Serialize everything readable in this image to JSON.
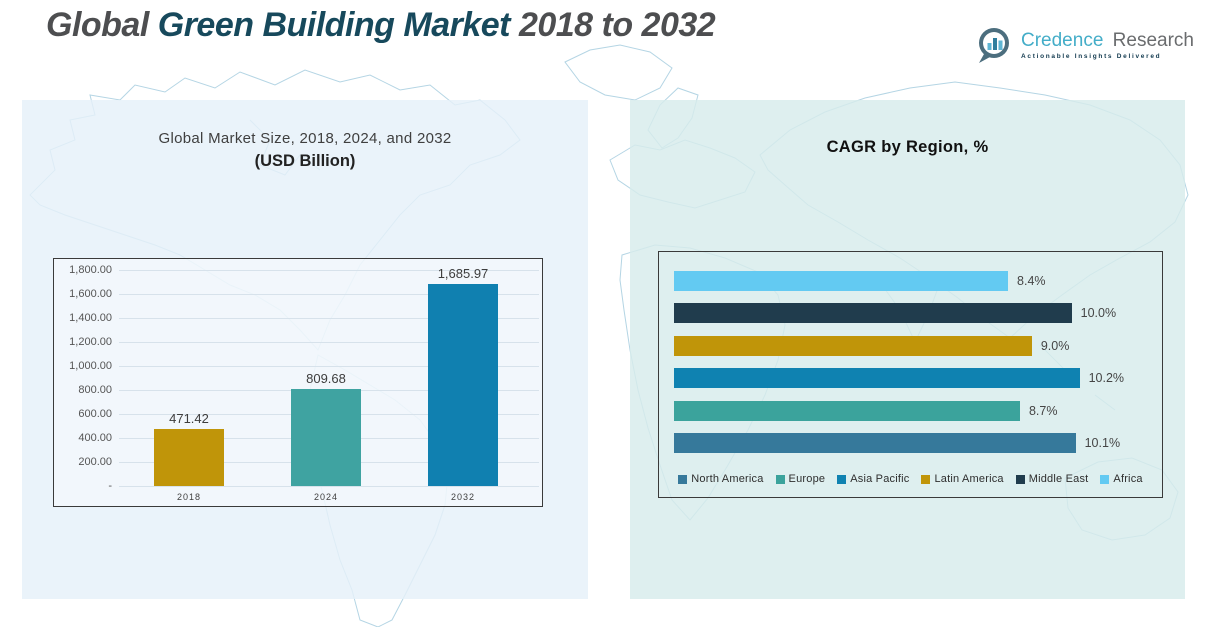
{
  "header": {
    "title": {
      "part1": "Global",
      "part2": "Green Building Market",
      "part3": "2018 to 2032"
    },
    "logo": {
      "brand_primary": "Credence",
      "brand_secondary": "Research",
      "tagline": "Actionable Insights Delivered",
      "icon": "bar-chart-speech-bubble-icon"
    }
  },
  "colors": {
    "title_gray": "#4d4e50",
    "title_teal": "#17495c",
    "left_panel_bg": "#EAF3FA",
    "right_panel_bg": "#DFF0F0",
    "gold": "#C09509",
    "teal": "#3FA3A1",
    "blue": "#1080B0",
    "sky_blue": "#63CAF2",
    "dark_navy": "#203C4D",
    "steel_blue": "#36799B",
    "map_outline": "#9cc7db"
  },
  "chart_data": [
    {
      "type": "bar",
      "title": "Global Market Size, 2018, 2024, and 2032",
      "subtitle": "(USD Billion)",
      "categories": [
        "2018",
        "2024",
        "2032"
      ],
      "values": [
        471.42,
        809.68,
        1685.97
      ],
      "data_labels": [
        "471.42",
        "809.68",
        "1,685.97"
      ],
      "bar_colors": [
        "#C09509",
        "#3FA3A1",
        "#1080B0"
      ],
      "xlabel": "",
      "ylabel": "",
      "ylim": [
        0,
        1800
      ],
      "ytick_step": 200,
      "ytick_labels_top_to_bottom": [
        "1,800.00",
        "1,600.00",
        "1,400.00",
        "1,200.00",
        "1,000.00",
        "800.00",
        "600.00",
        "400.00",
        "200.00",
        "-"
      ],
      "grid": true,
      "legend_position": "none"
    },
    {
      "type": "bar",
      "orientation": "horizontal",
      "title": "CAGR by Region, %",
      "categories_top_to_bottom": [
        "Africa",
        "Middle East",
        "Latin America",
        "Asia Pacific",
        "Europe",
        "North America"
      ],
      "values_top_to_bottom": [
        8.4,
        10.0,
        9.0,
        10.2,
        8.7,
        10.1
      ],
      "data_labels_top_to_bottom": [
        "8.4%",
        "10.0%",
        "9.0%",
        "10.2%",
        "8.7%",
        "10.1%"
      ],
      "bar_colors_top_to_bottom": [
        "#63CAF2",
        "#203C4D",
        "#C09509",
        "#0F82B1",
        "#3BA39C",
        "#36799B"
      ],
      "xlim": [
        0,
        12.7
      ],
      "grid": false,
      "legend_position": "bottom",
      "legend_items": [
        {
          "label": "North America",
          "color": "#36799B"
        },
        {
          "label": "Europe",
          "color": "#3BA39C"
        },
        {
          "label": "Asia Pacific",
          "color": "#0F82B1"
        },
        {
          "label": "Latin America",
          "color": "#C09509"
        },
        {
          "label": "Middle East",
          "color": "#203C4D"
        },
        {
          "label": "Africa",
          "color": "#63CAF2"
        }
      ]
    }
  ]
}
